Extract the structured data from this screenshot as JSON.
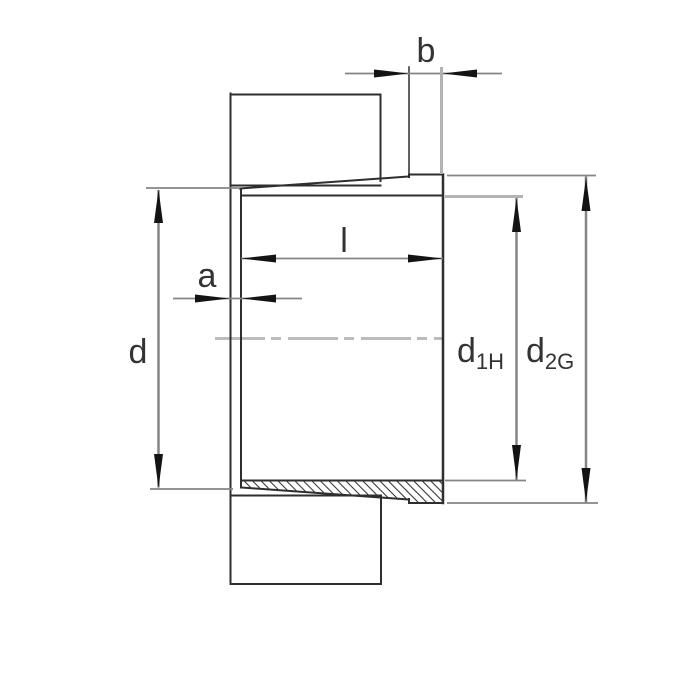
{
  "drawing": {
    "kind": "adapter-sleeve-cross-section"
  },
  "labels": {
    "b": "b",
    "l": "l",
    "a": "a",
    "d": "d",
    "d1h": {
      "base": "d",
      "sub": "1H"
    },
    "d2g": {
      "base": "d",
      "sub": "2G"
    }
  },
  "colors": {
    "background": "#ffffff",
    "outline": "#2e2e2e",
    "dimension": "#858585",
    "extension_light": "#b3b3b3",
    "arrow": "#141414",
    "centerline": "#bcbcbc",
    "hatch": "#333333",
    "label": "#333333"
  }
}
